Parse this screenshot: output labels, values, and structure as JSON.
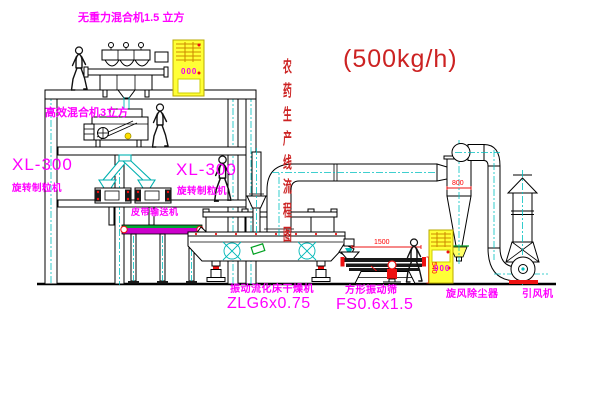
{
  "diagram": {
    "title": {
      "text": "农药生产线流程图",
      "capacity": "(500kg/h)"
    },
    "equipment_labels": {
      "gravity_free_mixer": "无重力混合机1.5 立方",
      "high_eff_mixer": "高效混合机3立方",
      "granulator_left": {
        "model": "XL-300",
        "name": "旋转制粒机"
      },
      "granulator_right": {
        "model": "XL-300",
        "name": "旋转制粒机"
      },
      "belt_conveyor": "皮带输送机",
      "fluid_bed_dryer": {
        "name": "振动流化床干燥机",
        "model": "ZLG6x0.75"
      },
      "square_sieve": {
        "name": "方形振动筛",
        "model": "FS0.6x1.5"
      },
      "cyclone": "旋风除尘器",
      "induced_draft_fan": "引风机"
    },
    "dimensions": {
      "sieve_length": "1500",
      "sieve_height": "540",
      "cyclone_dia": "800"
    },
    "control_cabinets": {
      "cabinet1_display": "000",
      "cabinet2_display": "000"
    },
    "colors": {
      "label_magenta": "#ff00ff",
      "title_red": "#cc2222",
      "dimension_red": "#ee1111",
      "centerline_cyan": "#00c0c0",
      "cabinet_yellow": "#ffff36",
      "line_black": "#000000",
      "background": "#ffffff"
    }
  }
}
